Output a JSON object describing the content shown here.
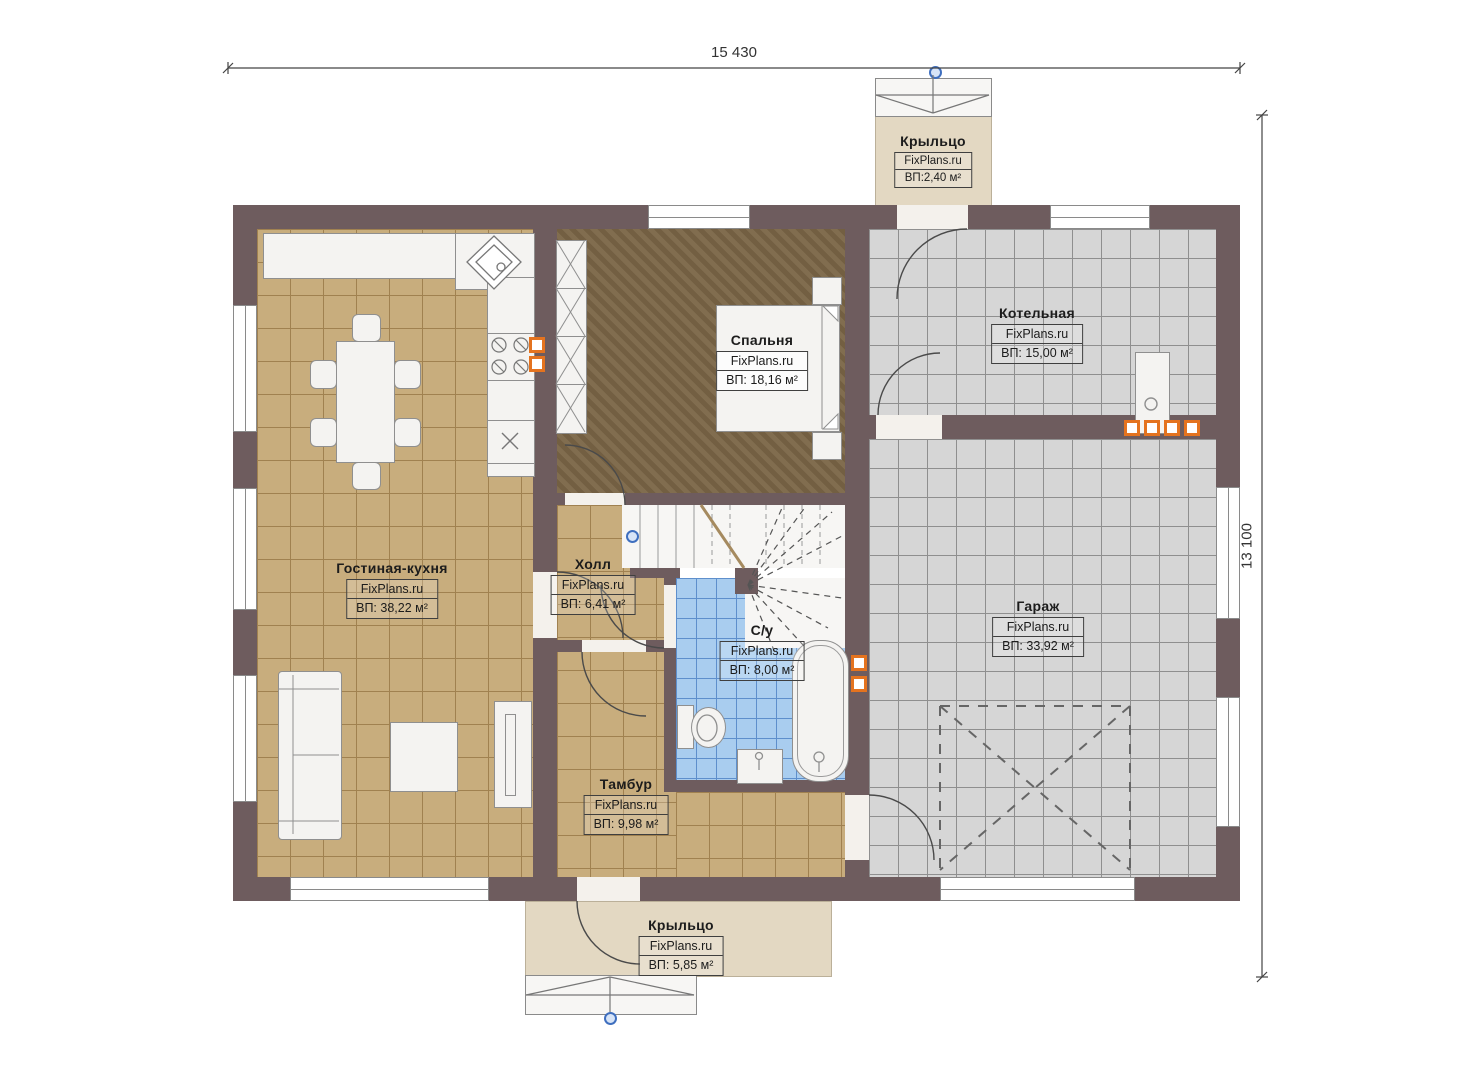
{
  "dimensions": {
    "width_label": "15 430",
    "height_label": "13 100"
  },
  "rooms": {
    "porch_top": {
      "name": "Крыльцо",
      "brand": "FixPlans.ru",
      "area": "ВП:2,40 м²"
    },
    "boiler": {
      "name": "Котельная",
      "brand": "FixPlans.ru",
      "area": "ВП: 15,00 м²"
    },
    "bedroom": {
      "name": "Спальня",
      "brand": "FixPlans.ru",
      "area": "ВП: 18,16 м²"
    },
    "living": {
      "name": "Гостиная-кухня",
      "brand": "FixPlans.ru",
      "area": "ВП: 38,22 м²"
    },
    "hall": {
      "name": "Холл",
      "brand": "FixPlans.ru",
      "area": "ВП: 6,41 м²"
    },
    "bath": {
      "name": "С/у",
      "brand": "FixPlans.ru",
      "area": "ВП: 8,00 м²"
    },
    "garage": {
      "name": "Гараж",
      "brand": "FixPlans.ru",
      "area": "ВП: 33,92 м²"
    },
    "tambour": {
      "name": "Тамбур",
      "brand": "FixPlans.ru",
      "area": "ВП: 9,98 м²"
    },
    "porch_bottom": {
      "name": "Крыльцо",
      "brand": "FixPlans.ru",
      "area": "ВП: 5,85 м²"
    }
  },
  "colors": {
    "wall": "#6E5C5E",
    "floor_tan": "#C8AD7D",
    "floor_gray": "#D6D6D6",
    "floor_blue": "#A9CDEF",
    "floor_brown": "#7A6546",
    "porch": "#E3D8C2",
    "accent_orange": "#E4731F",
    "marker_blue": "#3F6FBF"
  }
}
